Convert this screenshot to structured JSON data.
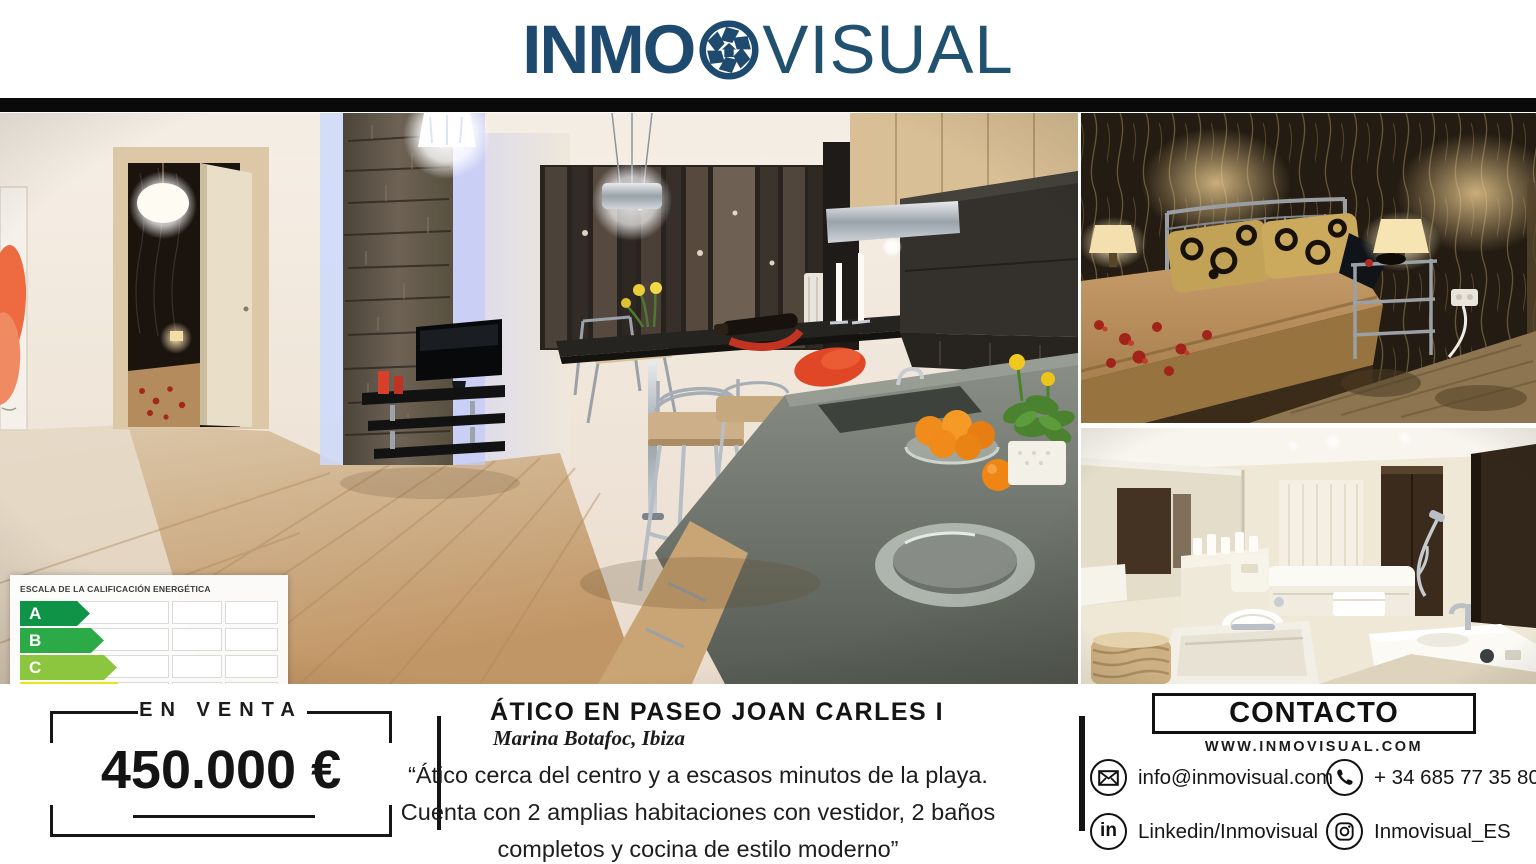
{
  "brand": {
    "name_bold": "INMO",
    "name_light": "VISUAL",
    "logo_color": "#1d4a6e"
  },
  "photos": {
    "main": "living-room-kitchen",
    "top_right": "bedroom",
    "bottom_right": "bathroom"
  },
  "energy_label": {
    "title": "ESCALA DE LA CALIFICACIÓN ENERGÉTICA",
    "rows": [
      {
        "letter": "A",
        "color": "#0f9447",
        "width_px": 70
      },
      {
        "letter": "B",
        "color": "#2baa47",
        "width_px": 84
      },
      {
        "letter": "C",
        "color": "#8cc63f",
        "width_px": 97
      },
      {
        "letter": "D",
        "color": "#e9e51e",
        "width_px": 110
      },
      {
        "letter": "E",
        "color": "#f4a81d",
        "width_px": 122
      },
      {
        "letter": "F",
        "color": "#ef7623",
        "width_px": 134
      },
      {
        "letter": "G",
        "color": "#ee3224",
        "width_px": 147
      }
    ]
  },
  "listing": {
    "status": "EN VENTA",
    "price": "450.000 €",
    "title": "ÁTICO EN PASEO JOAN CARLES I",
    "location": "Marina Botafoc, Ibiza",
    "description_lines": [
      "“Ático cerca del centro y a escasos minutos de la playa.",
      "Cuenta con 2 amplias habitaciones con vestidor, 2 baños",
      "completos y cocina de estilo moderno”"
    ]
  },
  "contact": {
    "heading": "CONTACTO",
    "website": "WWW.INMOVISUAL.COM",
    "linkedin_glyph": "in",
    "items": [
      {
        "icon": "email-icon",
        "label": "info@inmovisual.com"
      },
      {
        "icon": "phone-icon",
        "label": "+ 34 685 77 35 80"
      },
      {
        "icon": "linkedin-icon",
        "label": "Linkedin/Inmovisual"
      },
      {
        "icon": "instagram-icon",
        "label": "Inmovisual_ES"
      }
    ]
  }
}
